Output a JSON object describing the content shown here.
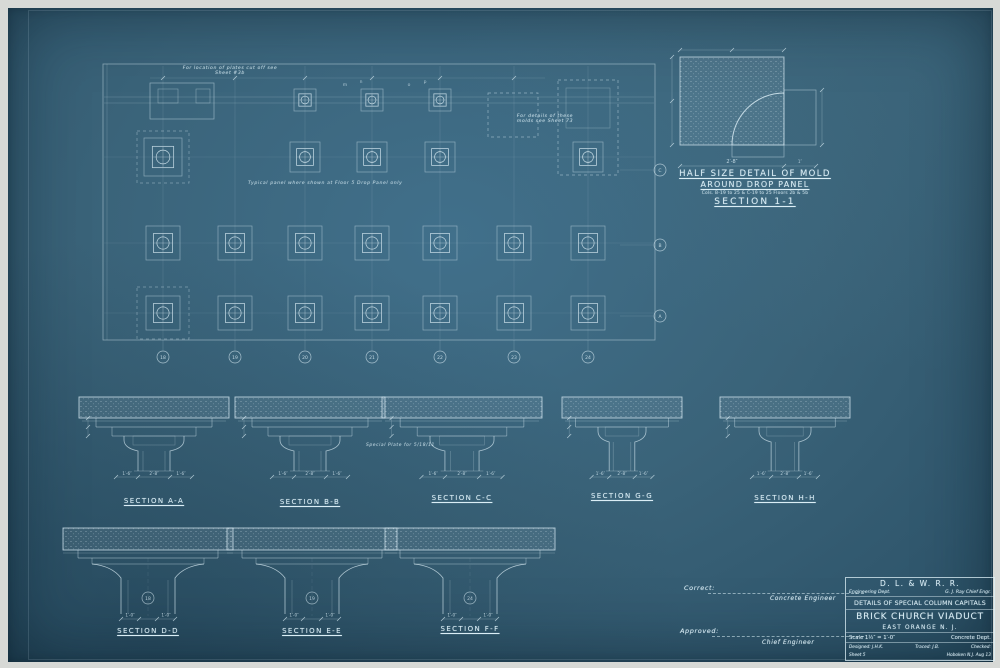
{
  "colors": {
    "paper": "#d7d9d6",
    "sheet": "#3a6379",
    "ink": "#d7eaf2"
  },
  "heading": {
    "line1": "HALF SIZE DETAIL OF MOLD",
    "line2": "AROUND DROP PANEL",
    "line3": "Cols. B-19 to 25 & C-19 to 25  Floors 2b & 5b",
    "line4": "SECTION 1-1"
  },
  "plan": {
    "notes": {
      "note_top": "For location of plates cut off see\nSheet #3b",
      "note_mold": "For details of these\nmolds see Sheet 73",
      "note_typical": "Typical panel where shown at Floor 5 Drop Panel only",
      "note_special": "Special Plate for 5/18/11"
    },
    "col_bubbles": [
      "18",
      "19",
      "20",
      "21",
      "22",
      "23",
      "24"
    ],
    "row_bubbles": [
      "C",
      "B",
      "A"
    ],
    "letters": [
      {
        "t": "m",
        "x": 345,
        "y": 86
      },
      {
        "t": "n",
        "x": 361,
        "y": 83
      },
      {
        "t": "o",
        "x": 409,
        "y": 86
      },
      {
        "t": "p",
        "x": 425,
        "y": 83
      }
    ]
  },
  "sections_row1": {
    "labels": [
      "SECTION A-A",
      "SECTION B-B",
      "SECTION C-C",
      "SECTION G-G",
      "SECTION H-H"
    ]
  },
  "sections_row2": {
    "labels": [
      "SECTION D-D",
      "SECTION E-E",
      "SECTION F-F"
    ],
    "shaft_bubbles": [
      "18",
      "19",
      "24"
    ]
  },
  "dims": {
    "row1": [
      "1′-6″",
      "2′-8″",
      "1′-6″"
    ],
    "row2": [
      "1′-0″",
      "1′-0″"
    ],
    "detail_w": "2′-8″",
    "detail_o": "1″"
  },
  "approvals": {
    "correct_label": "Correct:",
    "correct_role": "Concrete Engineer",
    "approved_label": "Approved:",
    "approved_role": "Chief Engineer"
  },
  "titleblock": {
    "railroad": "D. L. & W. R. R.",
    "dept": "Engineering Dept.",
    "chief": "G. J. Ray Chief Engr.",
    "title1": "DETAILS OF SPECIAL COLUMN CAPITALS",
    "title2": "BRICK CHURCH VIADUCT",
    "location": "EAST ORANGE N. J.",
    "scale": "Scale 1½″ = 1′-0″",
    "dept2": "Concrete Dept.",
    "designed": "Designed: J.H.K.",
    "traced": "Traced: J.B.",
    "checked": "Checked:",
    "sheet": "Sheet 5",
    "office": "Hoboken N.J. Aug 13"
  }
}
